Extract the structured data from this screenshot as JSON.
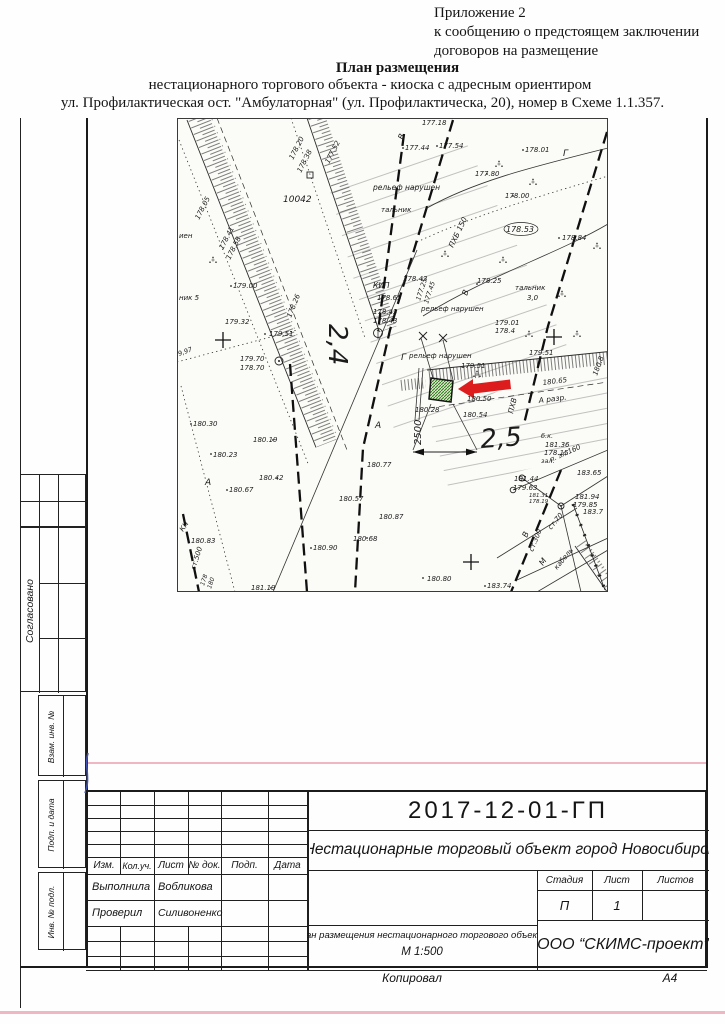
{
  "header": {
    "line1": "Приложение 2",
    "line2": "к сообщению о предстоящем заключении",
    "line3": "договоров на размещение",
    "title": "План размещения",
    "subtitle1": "нестационарного торгового объекта - киоска с адресным ориентиром",
    "subtitle2": "ул. Профилактическая ост. \"Амбулаторная\" (ул. Профилактическа, 20), номер в Схеме 1.1.357."
  },
  "side": {
    "agreed": "Согласовано",
    "vzam": "Взам. инв. №",
    "podp": "Подп. и дата",
    "inv": "Инв. № подл."
  },
  "stamp": {
    "doc_number": "2017-12-01-ГП",
    "object_line": "Нестационарные торговый объект город Новосибирск",
    "cols": [
      "Изм.",
      "Кол.уч.",
      "Лист",
      "№ док.",
      "Подп.",
      "Дата"
    ],
    "rows": [
      {
        "role": "Выполнила",
        "name": "Вобликова"
      },
      {
        "role": "Проверил",
        "name": "Силивоненко"
      }
    ],
    "stage_label": "Стадия",
    "sheet_label": "Лист",
    "sheets_label": "Листов",
    "stage": "П",
    "sheet": "1",
    "sheets": "",
    "plan_title": "План размещения нестационарного торгового объекта",
    "scale": "М 1:500",
    "company": "ООО “СКИМС-проект”",
    "copied_label": "Копировал",
    "format_label": "А4"
  },
  "map": {
    "arrow_color": "#dd1d1d",
    "kiosk_color": "#2c7a1e",
    "labels": [
      {
        "t": "178.05",
        "x": 22,
        "y": 102,
        "r": -63
      },
      {
        "t": "178.41",
        "x": 46,
        "y": 132,
        "r": -63
      },
      {
        "t": "178.58",
        "x": 53,
        "y": 142,
        "r": -63
      },
      {
        "t": "178.20",
        "x": 116,
        "y": 42,
        "r": -63
      },
      {
        "t": "178.38",
        "x": 124,
        "y": 55,
        "r": -63
      },
      {
        "t": "177.52",
        "x": 152,
        "y": 46,
        "r": -63
      },
      {
        "t": "10042",
        "x": 106,
        "y": 84,
        "s": 9
      },
      {
        "t": "рельеф нарушен",
        "x": 196,
        "y": 72,
        "s": 7.5
      },
      {
        "t": "тальник",
        "x": 204,
        "y": 94
      },
      {
        "t": "177.44",
        "x": 228,
        "y": 32
      },
      {
        "t": "177.54",
        "x": 262,
        "y": 30
      },
      {
        "t": "177.18",
        "x": 245,
        "y": 7
      },
      {
        "t": "178.01",
        "x": 348,
        "y": 34
      },
      {
        "t": "177.80",
        "x": 298,
        "y": 58
      },
      {
        "t": "178.00",
        "x": 328,
        "y": 80
      },
      {
        "t": "178.53",
        "x": 329,
        "y": 114,
        "s": 8
      },
      {
        "t": "178.84",
        "x": 385,
        "y": 122
      },
      {
        "t": "тальник",
        "x": 338,
        "y": 172
      },
      {
        "t": "3,0",
        "x": 350,
        "y": 182
      },
      {
        "t": "178.25",
        "x": 300,
        "y": 165
      },
      {
        "t": "рельеф нарушен",
        "x": 244,
        "y": 193
      },
      {
        "t": "КИП",
        "x": 196,
        "y": 170,
        "s": 7.5
      },
      {
        "t": "178.65",
        "x": 200,
        "y": 182
      },
      {
        "t": "178.43",
        "x": 226,
        "y": 163
      },
      {
        "t": "178.43",
        "x": 196,
        "y": 196
      },
      {
        "t": "178.43",
        "x": 196,
        "y": 205
      },
      {
        "t": "177.25",
        "x": 243,
        "y": 183,
        "r": -72,
        "s": 6.5
      },
      {
        "t": "177.45",
        "x": 251,
        "y": 186,
        "r": -72,
        "s": 6.5
      },
      {
        "t": "ПХБ 150",
        "x": 276,
        "y": 130,
        "r": -64,
        "s": 7.5
      },
      {
        "t": "В",
        "x": 226,
        "y": 22,
        "r": -70,
        "s": 8
      },
      {
        "t": "В",
        "x": 290,
        "y": 178,
        "r": -70,
        "s": 8
      },
      {
        "t": "Г",
        "x": 386,
        "y": 38,
        "s": 9
      },
      {
        "t": "Г",
        "x": 224,
        "y": 242,
        "s": 9
      },
      {
        "t": "179.00",
        "x": 56,
        "y": 170
      },
      {
        "t": "ник 5",
        "x": 2,
        "y": 182
      },
      {
        "t": "иен",
        "x": 2,
        "y": 120
      },
      {
        "t": "179.32",
        "x": 48,
        "y": 206
      },
      {
        "t": "179.51",
        "x": 92,
        "y": 218
      },
      {
        "t": "178.26",
        "x": 114,
        "y": 200,
        "r": -68
      },
      {
        "t": "179.70",
        "x": 63,
        "y": 243
      },
      {
        "t": "178.70",
        "x": 63,
        "y": 252
      },
      {
        "t": "9,97",
        "x": 2,
        "y": 238,
        "r": -20,
        "s": 6.5
      },
      {
        "t": "180.30",
        "x": 16,
        "y": 308
      },
      {
        "t": "180.19",
        "x": 76,
        "y": 324
      },
      {
        "t": "180.23",
        "x": 36,
        "y": 339
      },
      {
        "t": "180.42",
        "x": 82,
        "y": 362
      },
      {
        "t": "180.67",
        "x": 52,
        "y": 374
      },
      {
        "t": "А",
        "x": 28,
        "y": 367,
        "s": 9
      },
      {
        "t": "А",
        "x": 198,
        "y": 310,
        "s": 9
      },
      {
        "t": "180.77",
        "x": 190,
        "y": 349
      },
      {
        "t": "180.57",
        "x": 162,
        "y": 383
      },
      {
        "t": "180.83",
        "x": 14,
        "y": 425
      },
      {
        "t": "КН",
        "x": 6,
        "y": 414,
        "r": -55,
        "s": 7
      },
      {
        "t": "ст.500",
        "x": 18,
        "y": 452,
        "r": -72,
        "s": 7
      },
      {
        "t": "178",
        "x": 27,
        "y": 468,
        "r": -72,
        "s": 6
      },
      {
        "t": "180",
        "x": 34,
        "y": 471,
        "r": -72,
        "s": 6
      },
      {
        "t": "180.90",
        "x": 136,
        "y": 432
      },
      {
        "t": "180.68",
        "x": 176,
        "y": 423
      },
      {
        "t": "181.19",
        "x": 74,
        "y": 472
      },
      {
        "t": "180.87",
        "x": 202,
        "y": 401
      },
      {
        "t": "180.80",
        "x": 250,
        "y": 463
      },
      {
        "t": "183.74",
        "x": 310,
        "y": 470
      },
      {
        "t": "181.44",
        "x": 337,
        "y": 363
      },
      {
        "t": "179.63",
        "x": 336,
        "y": 372
      },
      {
        "t": "181.31",
        "x": 352,
        "y": 379,
        "s": 5.5
      },
      {
        "t": "178.19",
        "x": 352,
        "y": 385,
        "s": 5.5
      },
      {
        "t": "181.94",
        "x": 398,
        "y": 381
      },
      {
        "t": "179.85",
        "x": 396,
        "y": 389
      },
      {
        "t": "183.7",
        "x": 406,
        "y": 396
      },
      {
        "t": "183.65",
        "x": 400,
        "y": 357
      },
      {
        "t": "п. эл.160",
        "x": 374,
        "y": 344,
        "r": -24,
        "s": 7
      },
      {
        "t": "б.к.",
        "x": 364,
        "y": 320,
        "s": 6.5
      },
      {
        "t": "181.36",
        "x": 368,
        "y": 329
      },
      {
        "t": "178.15",
        "x": 367,
        "y": 337
      },
      {
        "t": "зал.",
        "x": 364,
        "y": 345,
        "s": 6.5
      },
      {
        "t": "179.51",
        "x": 284,
        "y": 250
      },
      {
        "t": "179.51",
        "x": 352,
        "y": 237
      },
      {
        "t": "179.01",
        "x": 318,
        "y": 207
      },
      {
        "t": "178.4",
        "x": 318,
        "y": 215
      },
      {
        "t": "рельеф нарушен",
        "x": 232,
        "y": 240
      },
      {
        "t": "180.50",
        "x": 290,
        "y": 283
      },
      {
        "t": "180.28",
        "x": 238,
        "y": 294
      },
      {
        "t": "180.54",
        "x": 286,
        "y": 299
      },
      {
        "t": "180.65",
        "x": 366,
        "y": 267,
        "r": -7
      },
      {
        "t": "180.8",
        "x": 420,
        "y": 258,
        "r": -70
      },
      {
        "t": "А разр.",
        "x": 362,
        "y": 285,
        "r": -7,
        "s": 7.5
      },
      {
        "t": "ПХВ",
        "x": 336,
        "y": 296,
        "r": -76,
        "s": 7.5
      },
      {
        "t": "В",
        "x": 350,
        "y": 420,
        "r": -68,
        "s": 8
      },
      {
        "t": "ст.300",
        "x": 356,
        "y": 434,
        "r": -68,
        "s": 7
      },
      {
        "t": "ст.70",
        "x": 374,
        "y": 412,
        "r": -50,
        "s": 7
      },
      {
        "t": "М",
        "x": 366,
        "y": 448,
        "r": -55,
        "s": 8
      },
      {
        "t": "кабель",
        "x": 380,
        "y": 452,
        "r": -50,
        "s": 7
      },
      {
        "t": "2,4",
        "x": 152,
        "y": 206,
        "r": 90,
        "s": 26
      },
      {
        "t": "2,5",
        "x": 304,
        "y": 330,
        "r": -4,
        "s": 26
      },
      {
        "t": "2500",
        "x": 244,
        "y": 327,
        "r": -90,
        "s": 10
      }
    ]
  }
}
